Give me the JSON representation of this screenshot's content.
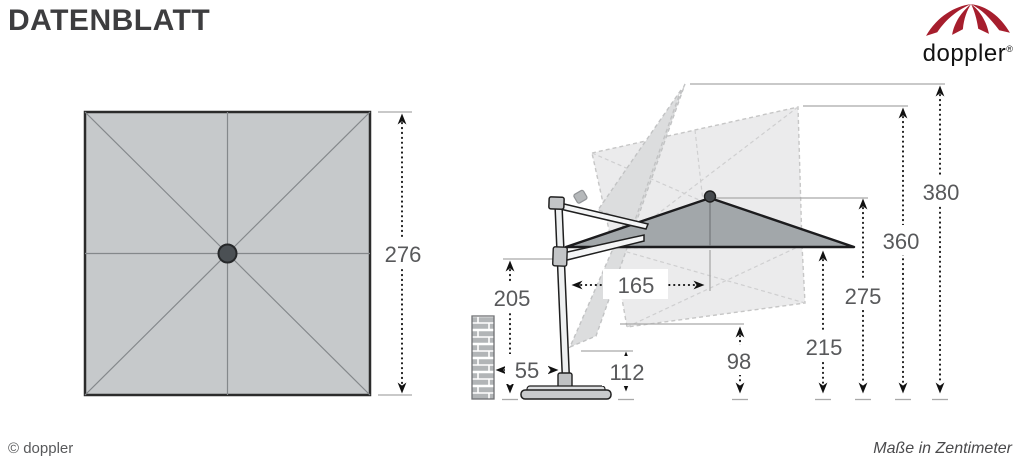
{
  "header": {
    "title": "DATENBLATT",
    "logo": {
      "brand": "doppler",
      "registered_mark": "®",
      "icon": "doppler-umbrella-icon"
    }
  },
  "footer": {
    "copyright": "© doppler",
    "units_note": "Maße in Zentimeter"
  },
  "colors": {
    "brand_red": "#A61E2D",
    "canopy_side_gray": "#A2A7AA",
    "canopy_top_gray": "#C6C9CB",
    "dimension_text_gray": "#58595B",
    "ghost_gray": "#EBEBEC"
  },
  "top_view": {
    "canopy_width": "276"
  },
  "side_view": {
    "dims": {
      "d380": "380",
      "d360": "360",
      "d275": "275",
      "d215": "215",
      "d165": "165",
      "d112": "112",
      "d98": "98",
      "d55": "55",
      "d205": "205"
    }
  }
}
